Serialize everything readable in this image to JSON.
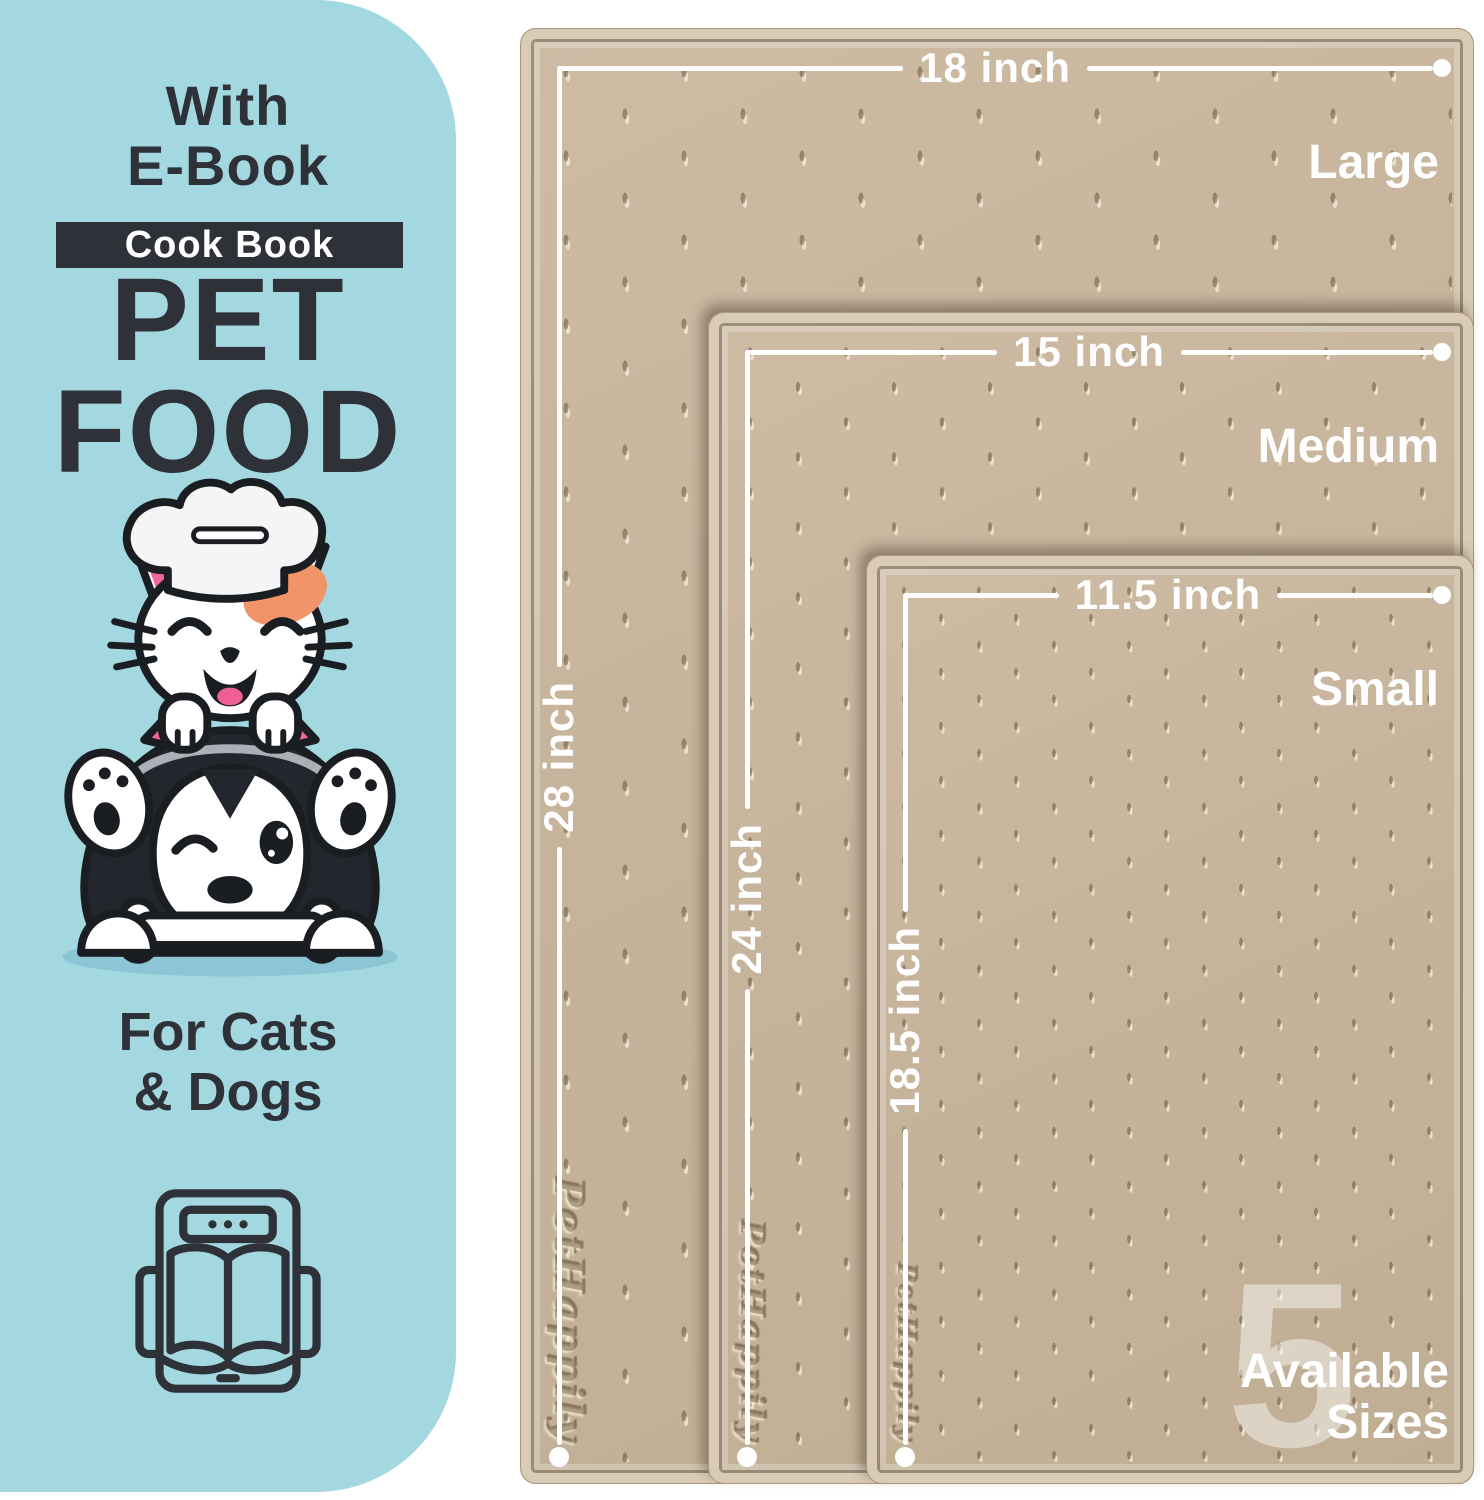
{
  "left_panel": {
    "heading_line1": "With",
    "heading_line2": "E-Book",
    "badge_label": "Cook Book",
    "title_line1": "PET",
    "title_line2": "FOOD",
    "subtitle_line1": "For Cats",
    "subtitle_line2": "& Dogs"
  },
  "mats": {
    "sizes": [
      {
        "name": "Large",
        "width": "18 inch",
        "height": "28 inch"
      },
      {
        "name": "Medium",
        "width": "15 inch",
        "height": "24 inch"
      },
      {
        "name": "Small",
        "width": "11.5 inch",
        "height": "18.5 inch"
      }
    ],
    "embossed_brand": "PetHappily",
    "available": {
      "count": "5",
      "line1": "Available",
      "line2": "Sizes"
    }
  },
  "colors": {
    "panel_blue": "#a4d8e1",
    "mat_surface": "#c6b49c",
    "mat_rim": "#dacbb5",
    "text_dark": "#2e3137",
    "annotation_white": "#ffffff"
  }
}
